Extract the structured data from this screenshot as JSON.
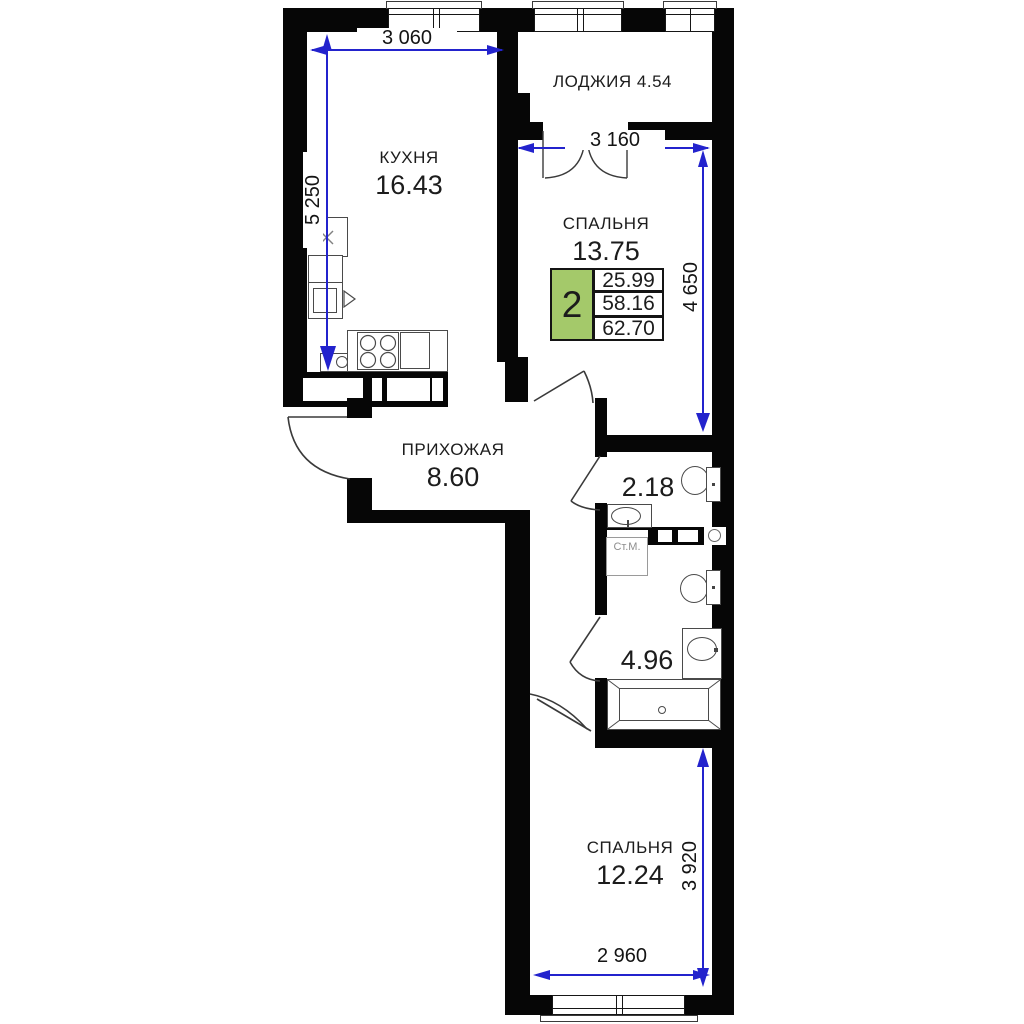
{
  "rooms": {
    "kitchen": {
      "name": "КУХНЯ",
      "area": "16.43"
    },
    "loggia": {
      "name": "ЛОДЖИЯ",
      "area": "4.54"
    },
    "bedroom1": {
      "name": "СПАЛЬНЯ",
      "area": "13.75"
    },
    "hallway": {
      "name": "ПРИХОЖАЯ",
      "area": "8.60"
    },
    "wc": {
      "area": "2.18"
    },
    "bathroom": {
      "area": "4.96"
    },
    "bedroom2": {
      "name": "СПАЛЬНЯ",
      "area": "12.24"
    }
  },
  "appliances": {
    "washing_machine": "Ст.М."
  },
  "info_box": {
    "rooms": "2",
    "living_area": "25.99",
    "area": "58.16",
    "total_area": "62.70"
  },
  "dimensions": {
    "kitchen_width": "3 060",
    "kitchen_depth": "5 250",
    "bedroom1_width": "3 160",
    "bedroom1_depth": "4 650",
    "bedroom2_depth": "3 920",
    "bedroom2_width": "2 960"
  },
  "colors": {
    "wall": "#060606",
    "dimension_blue": "#2323cd",
    "info_green": "#a4c96a"
  }
}
